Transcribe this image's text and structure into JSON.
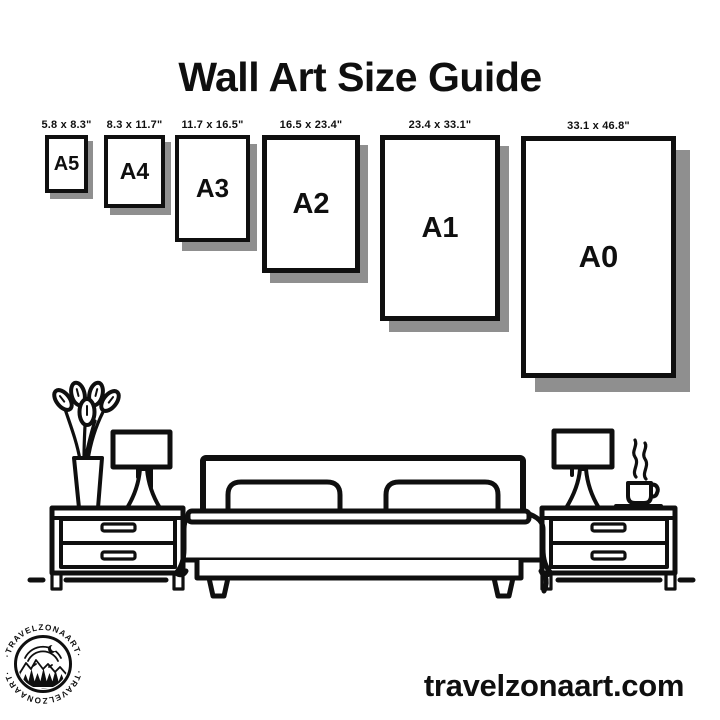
{
  "title": "Wall Art Size Guide",
  "sizes": [
    {
      "name": "A5",
      "dimensions": "5.8 x 8.3\""
    },
    {
      "name": "A4",
      "dimensions": "8.3 x 11.7\""
    },
    {
      "name": "A3",
      "dimensions": "11.7 x 16.5\""
    },
    {
      "name": "A2",
      "dimensions": "16.5 x 23.4\""
    },
    {
      "name": "A1",
      "dimensions": "23.4 x 33.1\""
    },
    {
      "name": "A0",
      "dimensions": "33.1 x 46.8\""
    }
  ],
  "logo": {
    "brand_top": "·TRAVELZONAART·",
    "brand_bottom": "·TRAVELZONAART·"
  },
  "footer": {
    "website": "travelzonaart.com"
  },
  "colors": {
    "ink": "#0f0f0f",
    "paper": "#ffffff",
    "shadow": "#8f8f8f"
  },
  "scene_icons": [
    "flower-vase-icon",
    "table-lamp-icon",
    "nightstand-icon",
    "bed-icon",
    "pillow-icon",
    "coffee-cup-icon"
  ]
}
